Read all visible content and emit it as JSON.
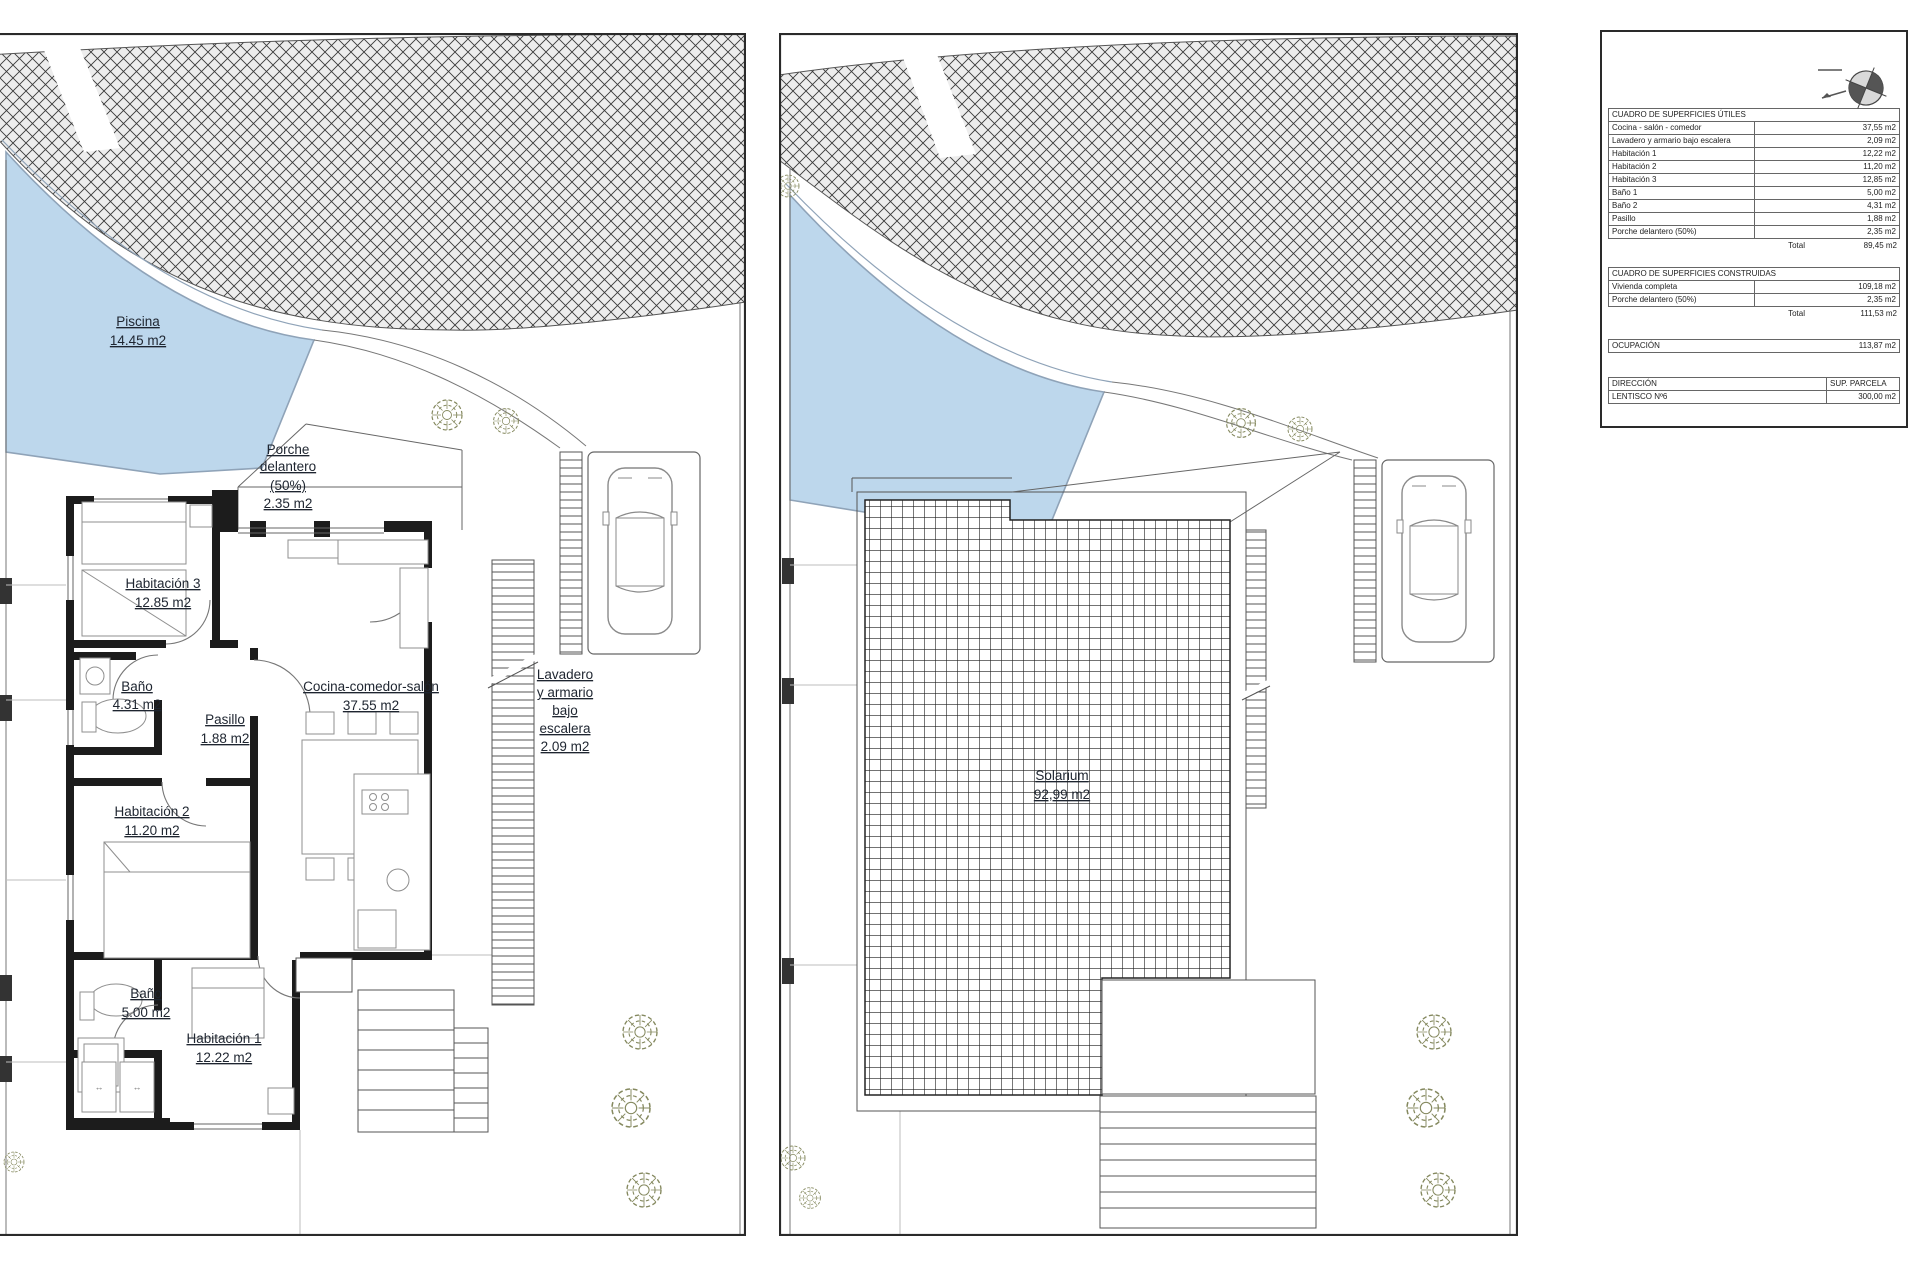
{
  "plans": {
    "window_symbol": "↔",
    "left": {
      "piscina": [
        "Piscina",
        "14.45 m2"
      ],
      "porche": [
        "Porche",
        "delantero",
        "(50%)",
        "2.35 m2"
      ],
      "habitacion3": [
        "Habitación 3",
        "12.85 m2"
      ],
      "bano2": [
        "Baño",
        "4.31 m2"
      ],
      "pasillo": [
        "Pasillo",
        "1.88 m2"
      ],
      "cocina": [
        "Cocina-comedor-salón",
        "37.55 m2"
      ],
      "lavadero": [
        "Lavadero",
        "y armario",
        "bajo",
        "escalera",
        "2.09 m2"
      ],
      "habitacion2": [
        "Habitación 2",
        "11.20 m2"
      ],
      "bano1": [
        "Baño",
        "5.00 m2"
      ],
      "habitacion1": [
        "Habitación 1",
        "12.22 m2"
      ]
    },
    "right": {
      "solarium": [
        "Solarium",
        "92,99 m2"
      ]
    }
  },
  "info": {
    "utiles": {
      "title": "CUADRO DE SUPERFICIES ÚTILES",
      "rows": [
        [
          "Cocina - salón - comedor",
          "37,55 m2"
        ],
        [
          "Lavadero y armario bajo escalera",
          "2,09 m2"
        ],
        [
          "Habitación 1",
          "12,22 m2"
        ],
        [
          "Habitación 2",
          "11,20 m2"
        ],
        [
          "Habitación 3",
          "12,85 m2"
        ],
        [
          "Baño 1",
          "5,00 m2"
        ],
        [
          "Baño 2",
          "4,31 m2"
        ],
        [
          "Pasillo",
          "1,88 m2"
        ],
        [
          "Porche delantero (50%)",
          "2,35 m2"
        ]
      ],
      "total_label": "Total",
      "total_value": "89,45 m2"
    },
    "construidas": {
      "title": "CUADRO DE SUPERFICIES CONSTRUIDAS",
      "rows": [
        [
          "Vivienda completa",
          "109,18 m2"
        ],
        [
          "Porche delantero (50%)",
          "2,35 m2"
        ]
      ],
      "total_label": "Total",
      "total_value": "111,53 m2"
    },
    "ocupacion": {
      "label": "OCUPACIÓN",
      "value": "113,87 m2"
    },
    "direccion": {
      "rows": [
        [
          "DIRECCIÓN",
          "SUP. PARCELA"
        ],
        [
          "LENTISCO Nº6",
          "300,00 m2"
        ]
      ]
    }
  },
  "colors": {
    "pool": "#bdd7ec",
    "pool_edge": "#8fa3b8",
    "wall": "#1c1c1c",
    "plant": "#85895f"
  }
}
